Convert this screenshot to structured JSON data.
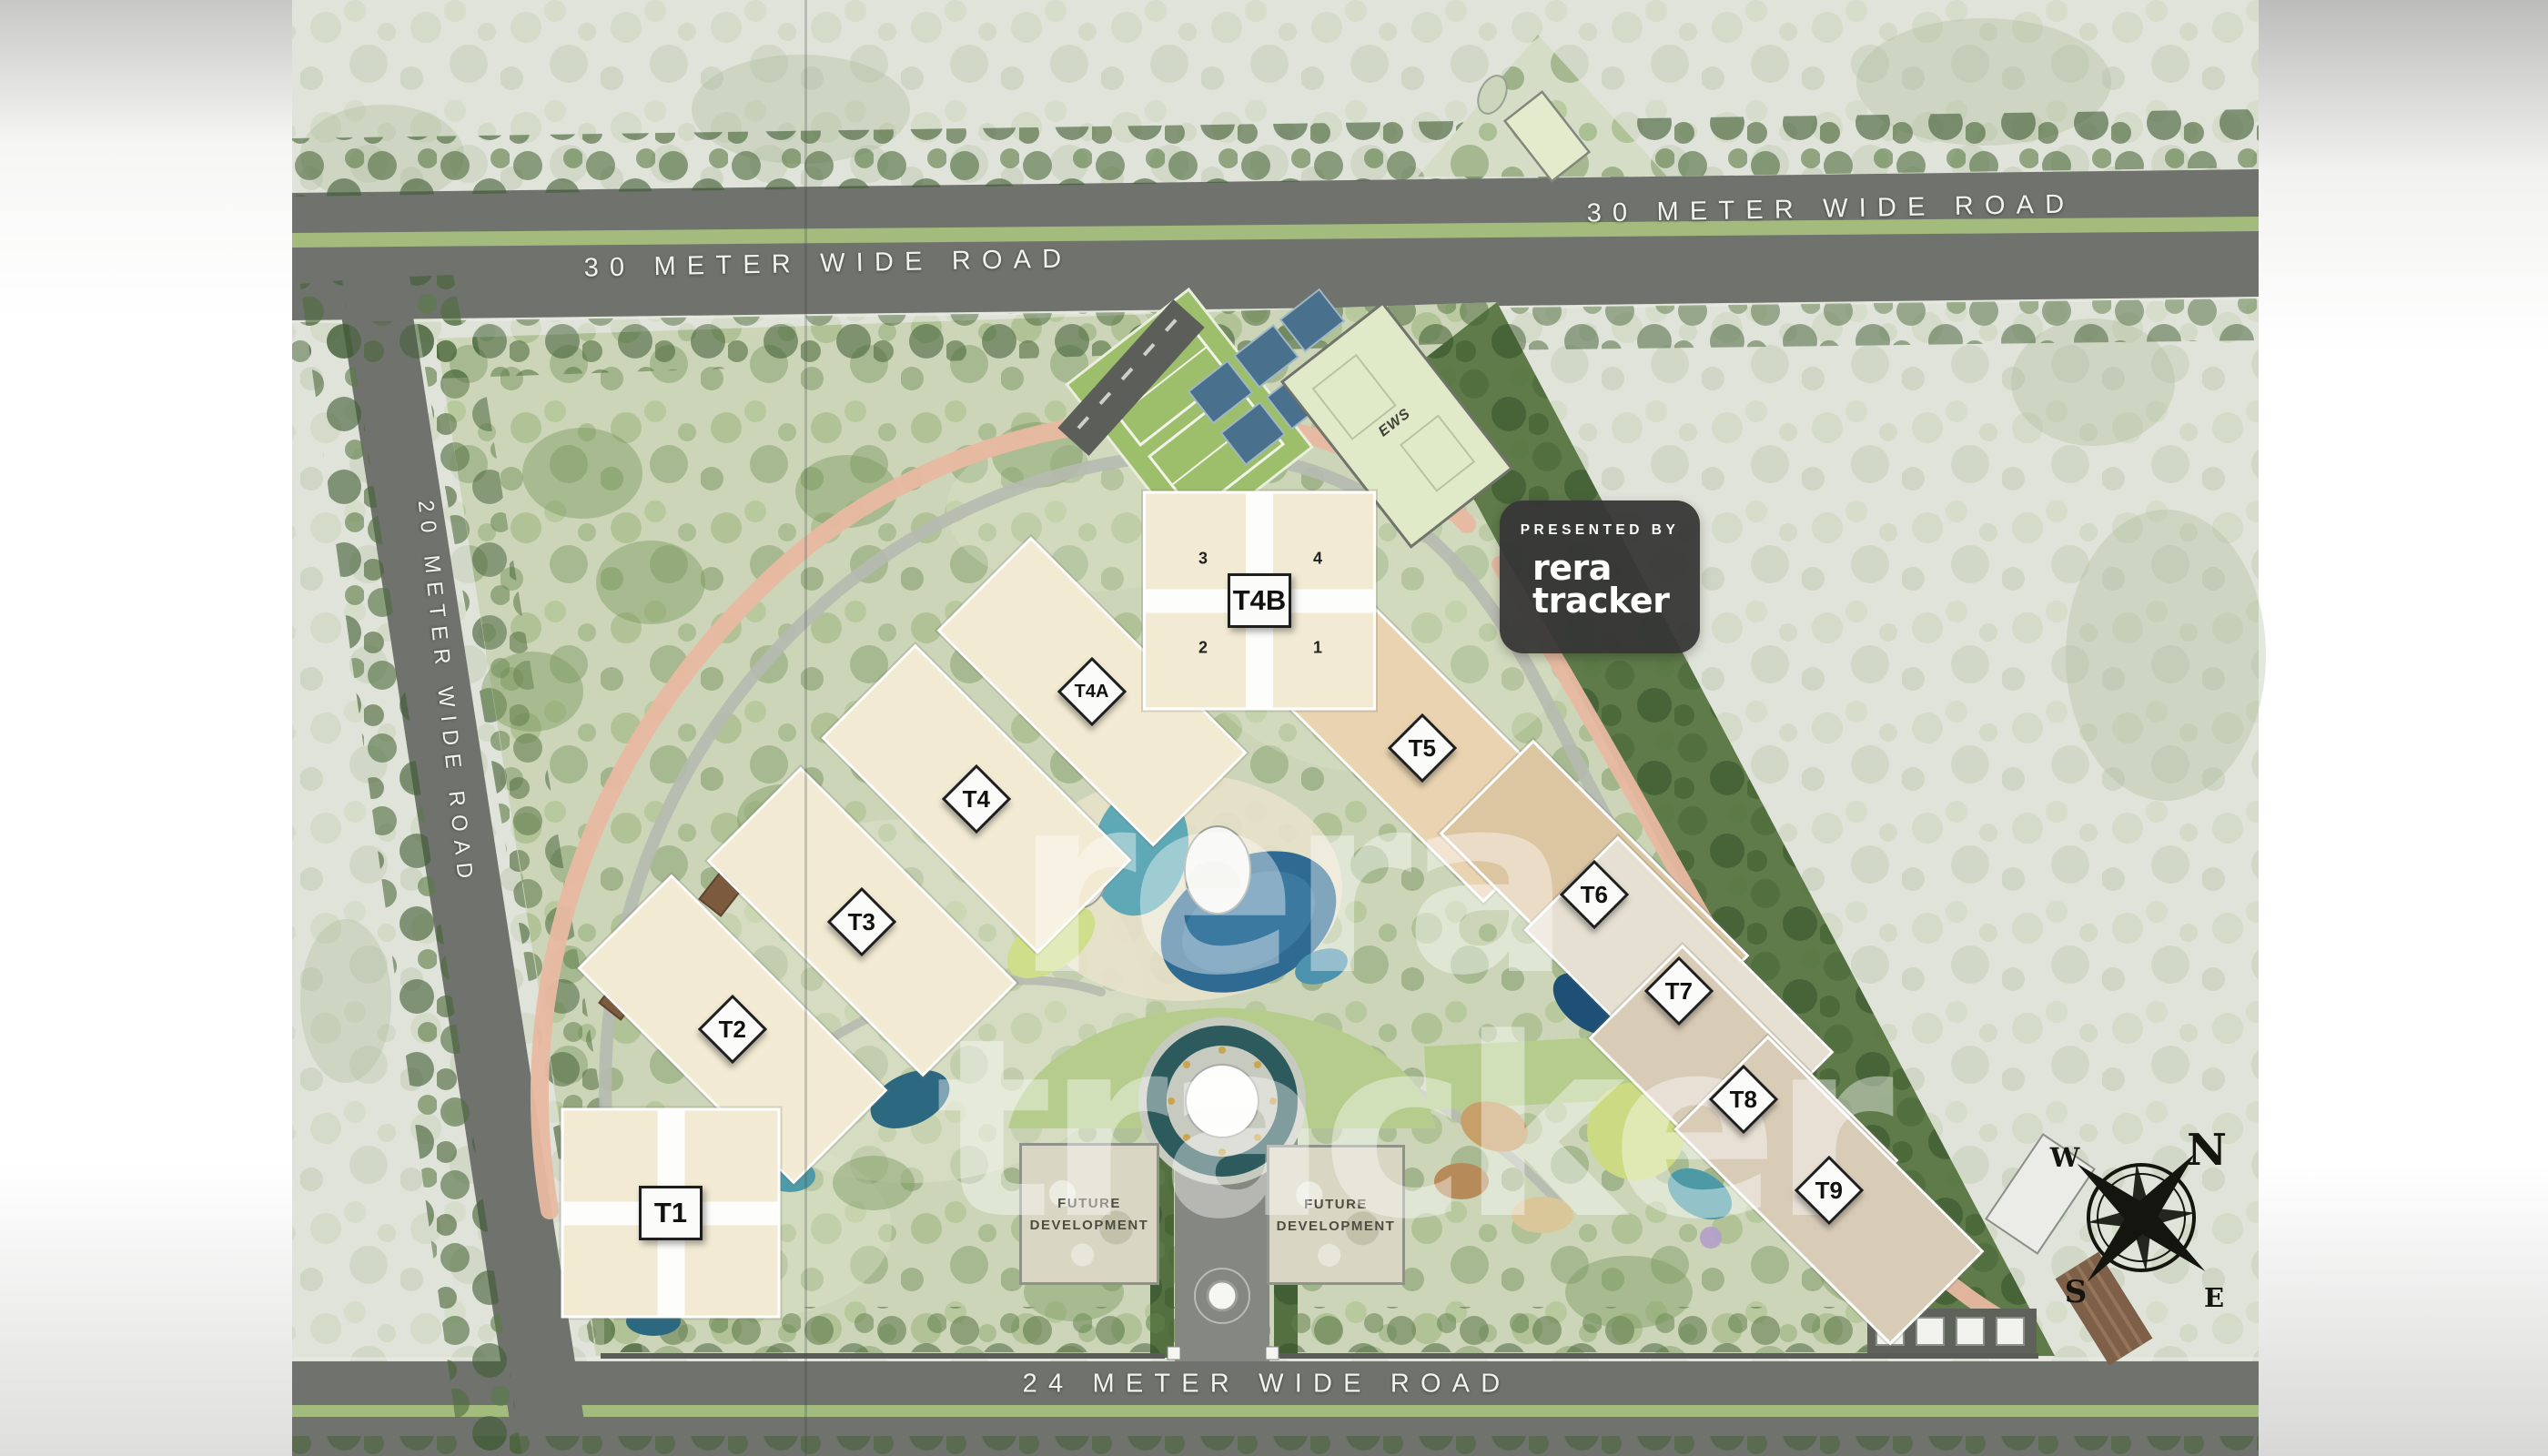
{
  "page": {
    "type": "residential-township-master-plan"
  },
  "watermark": {
    "line1": "rera",
    "line2": "tracker"
  },
  "badge": {
    "presented_by": "PRESENTED BY",
    "brand_line1": "rera",
    "brand_line2": "tracker"
  },
  "roads": {
    "top_left_label": "30 METER WIDE ROAD",
    "top_right_label": "30 METER WIDE ROAD",
    "left_label": "20 METER WIDE ROAD",
    "bottom_label": "24 METER WIDE ROAD"
  },
  "towers": [
    {
      "id": "t1",
      "label": "T1",
      "shape": "square"
    },
    {
      "id": "t2",
      "label": "T2",
      "shape": "diamond"
    },
    {
      "id": "t3",
      "label": "T3",
      "shape": "diamond"
    },
    {
      "id": "t4",
      "label": "T4",
      "shape": "diamond"
    },
    {
      "id": "t4a",
      "label": "T4A",
      "shape": "diamond"
    },
    {
      "id": "t4b",
      "label": "T4B",
      "shape": "square"
    },
    {
      "id": "t5",
      "label": "T5",
      "shape": "diamond"
    },
    {
      "id": "t6",
      "label": "T6",
      "shape": "diamond"
    },
    {
      "id": "t7",
      "label": "T7",
      "shape": "diamond"
    },
    {
      "id": "t8",
      "label": "T8",
      "shape": "diamond"
    },
    {
      "id": "t9",
      "label": "T9",
      "shape": "diamond"
    }
  ],
  "t4b_wing_numbers": {
    "top_left": "3",
    "top_right": "4",
    "bottom_left": "2",
    "bottom_right": "1"
  },
  "plots": {
    "future_left_line1": "FUTURE",
    "future_left_line2": "DEVELOPMENT",
    "future_right_line1": "FUTURE",
    "future_right_line2": "DEVELOPMENT",
    "ews_label": "EWS"
  },
  "compass": {
    "n": "N",
    "e": "E",
    "s": "S",
    "w": "W"
  },
  "colors": {
    "road": "#6f726d",
    "road_median": "#a3bc7e",
    "site_green": "#ccd5b8",
    "building_cream": "#f2ead3",
    "pool_blue": "#2e6a92",
    "promenade_salmon": "#e8b9a1",
    "badge_bg": "#373737",
    "label_plate": "#fbfbfa"
  }
}
